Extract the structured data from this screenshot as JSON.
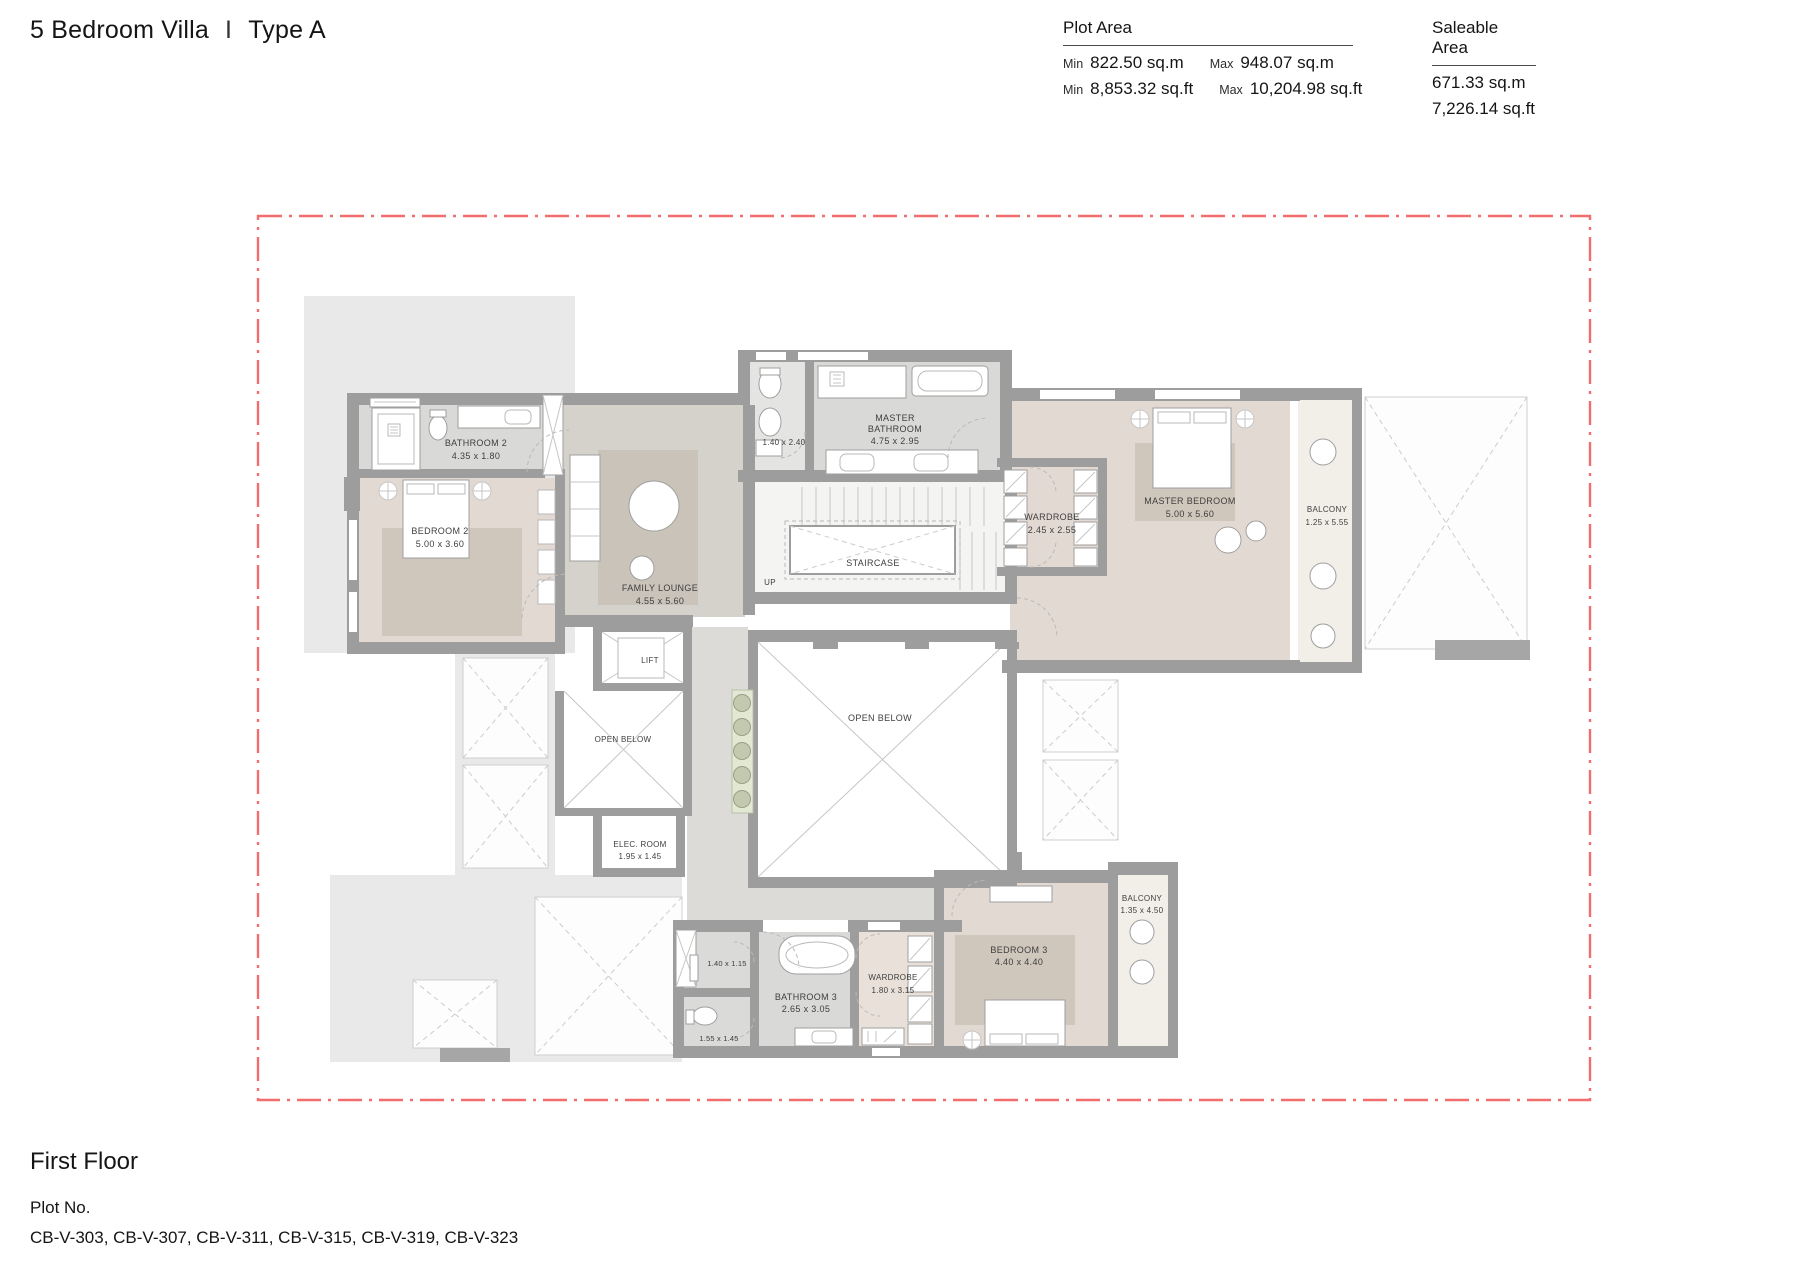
{
  "header": {
    "title": "5 Bedroom Villa",
    "separator": "I",
    "villa_type": "Type A",
    "plot_area": {
      "label": "Plot Area",
      "min_label": "Min",
      "max_label": "Max",
      "min_sqm": "822.50 sq.m",
      "max_sqm": "948.07 sq.m",
      "min_sqft": "8,853.32 sq.ft",
      "max_sqft": "10,204.98 sq.ft"
    },
    "saleable_area": {
      "label": "Saleable Area",
      "sqm": "671.33 sq.m",
      "sqft": "7,226.14 sq.ft"
    }
  },
  "footer": {
    "floor_name": "First Floor",
    "plot_no_label": "Plot No.",
    "plot_numbers": "CB-V-303, CB-V-307, CB-V-311, CB-V-315, CB-V-319, CB-V-323"
  },
  "rooms": {
    "bathroom2": {
      "name": "BATHROOM 2",
      "dims": "4.35 x 1.80"
    },
    "bedroom2": {
      "name": "BEDROOM 2",
      "dims": "5.00 x 3.60"
    },
    "family_lounge": {
      "name": "FAMILY LOUNGE",
      "dims": "4.55 x 5.60"
    },
    "wc_upper": {
      "dims": "1.40 x 2.40"
    },
    "master_bathroom": {
      "name1": "MASTER",
      "name2": "BATHROOM",
      "dims": "4.75 x 2.95"
    },
    "staircase": {
      "name": "STAIRCASE"
    },
    "up_label": "UP",
    "wardrobe_master": {
      "name": "WARDROBE",
      "dims": "2.45 x 2.55"
    },
    "master_bedroom": {
      "name": "MASTER  BEDROOM",
      "dims": "5.00 x 5.60"
    },
    "balcony_master": {
      "name": "BALCONY",
      "dims": "1.25 x 5.55"
    },
    "lift": {
      "name": "LIFT"
    },
    "open_below_left": {
      "name": "OPEN BELOW"
    },
    "elec_room": {
      "name": "ELEC. ROOM",
      "dims": "1.95 x 1.45"
    },
    "open_below_center": {
      "name": "OPEN BELOW"
    },
    "wc3a": {
      "dims": "1.40 x 1.15"
    },
    "wc3b": {
      "dims": "1.55 x 1.45"
    },
    "bathroom3": {
      "name": "BATHROOM 3",
      "dims": "2.65 x 3.05"
    },
    "wardrobe3": {
      "name": "WARDROBE",
      "dims": "1.80 x 3.15"
    },
    "bedroom3": {
      "name": "BEDROOM 3",
      "dims": "4.40 x 4.40"
    },
    "balcony3": {
      "name": "BALCONY",
      "dims": "1.35 x 4.50"
    }
  },
  "colors": {
    "boundary_red": "#f26d6d",
    "wall_gray": "#9d9d9d",
    "bedroom_floor": "#e3d9d3",
    "rug": "#cfc6bc",
    "bathroom_floor": "#d9d9d7",
    "lounge_floor": "#d5d2cb",
    "corridor_floor": "#dcdbd8",
    "balcony_floor": "#f2efe8",
    "terrace_patch": "#e9e9e9",
    "planter_green": "#c2c9ae"
  }
}
